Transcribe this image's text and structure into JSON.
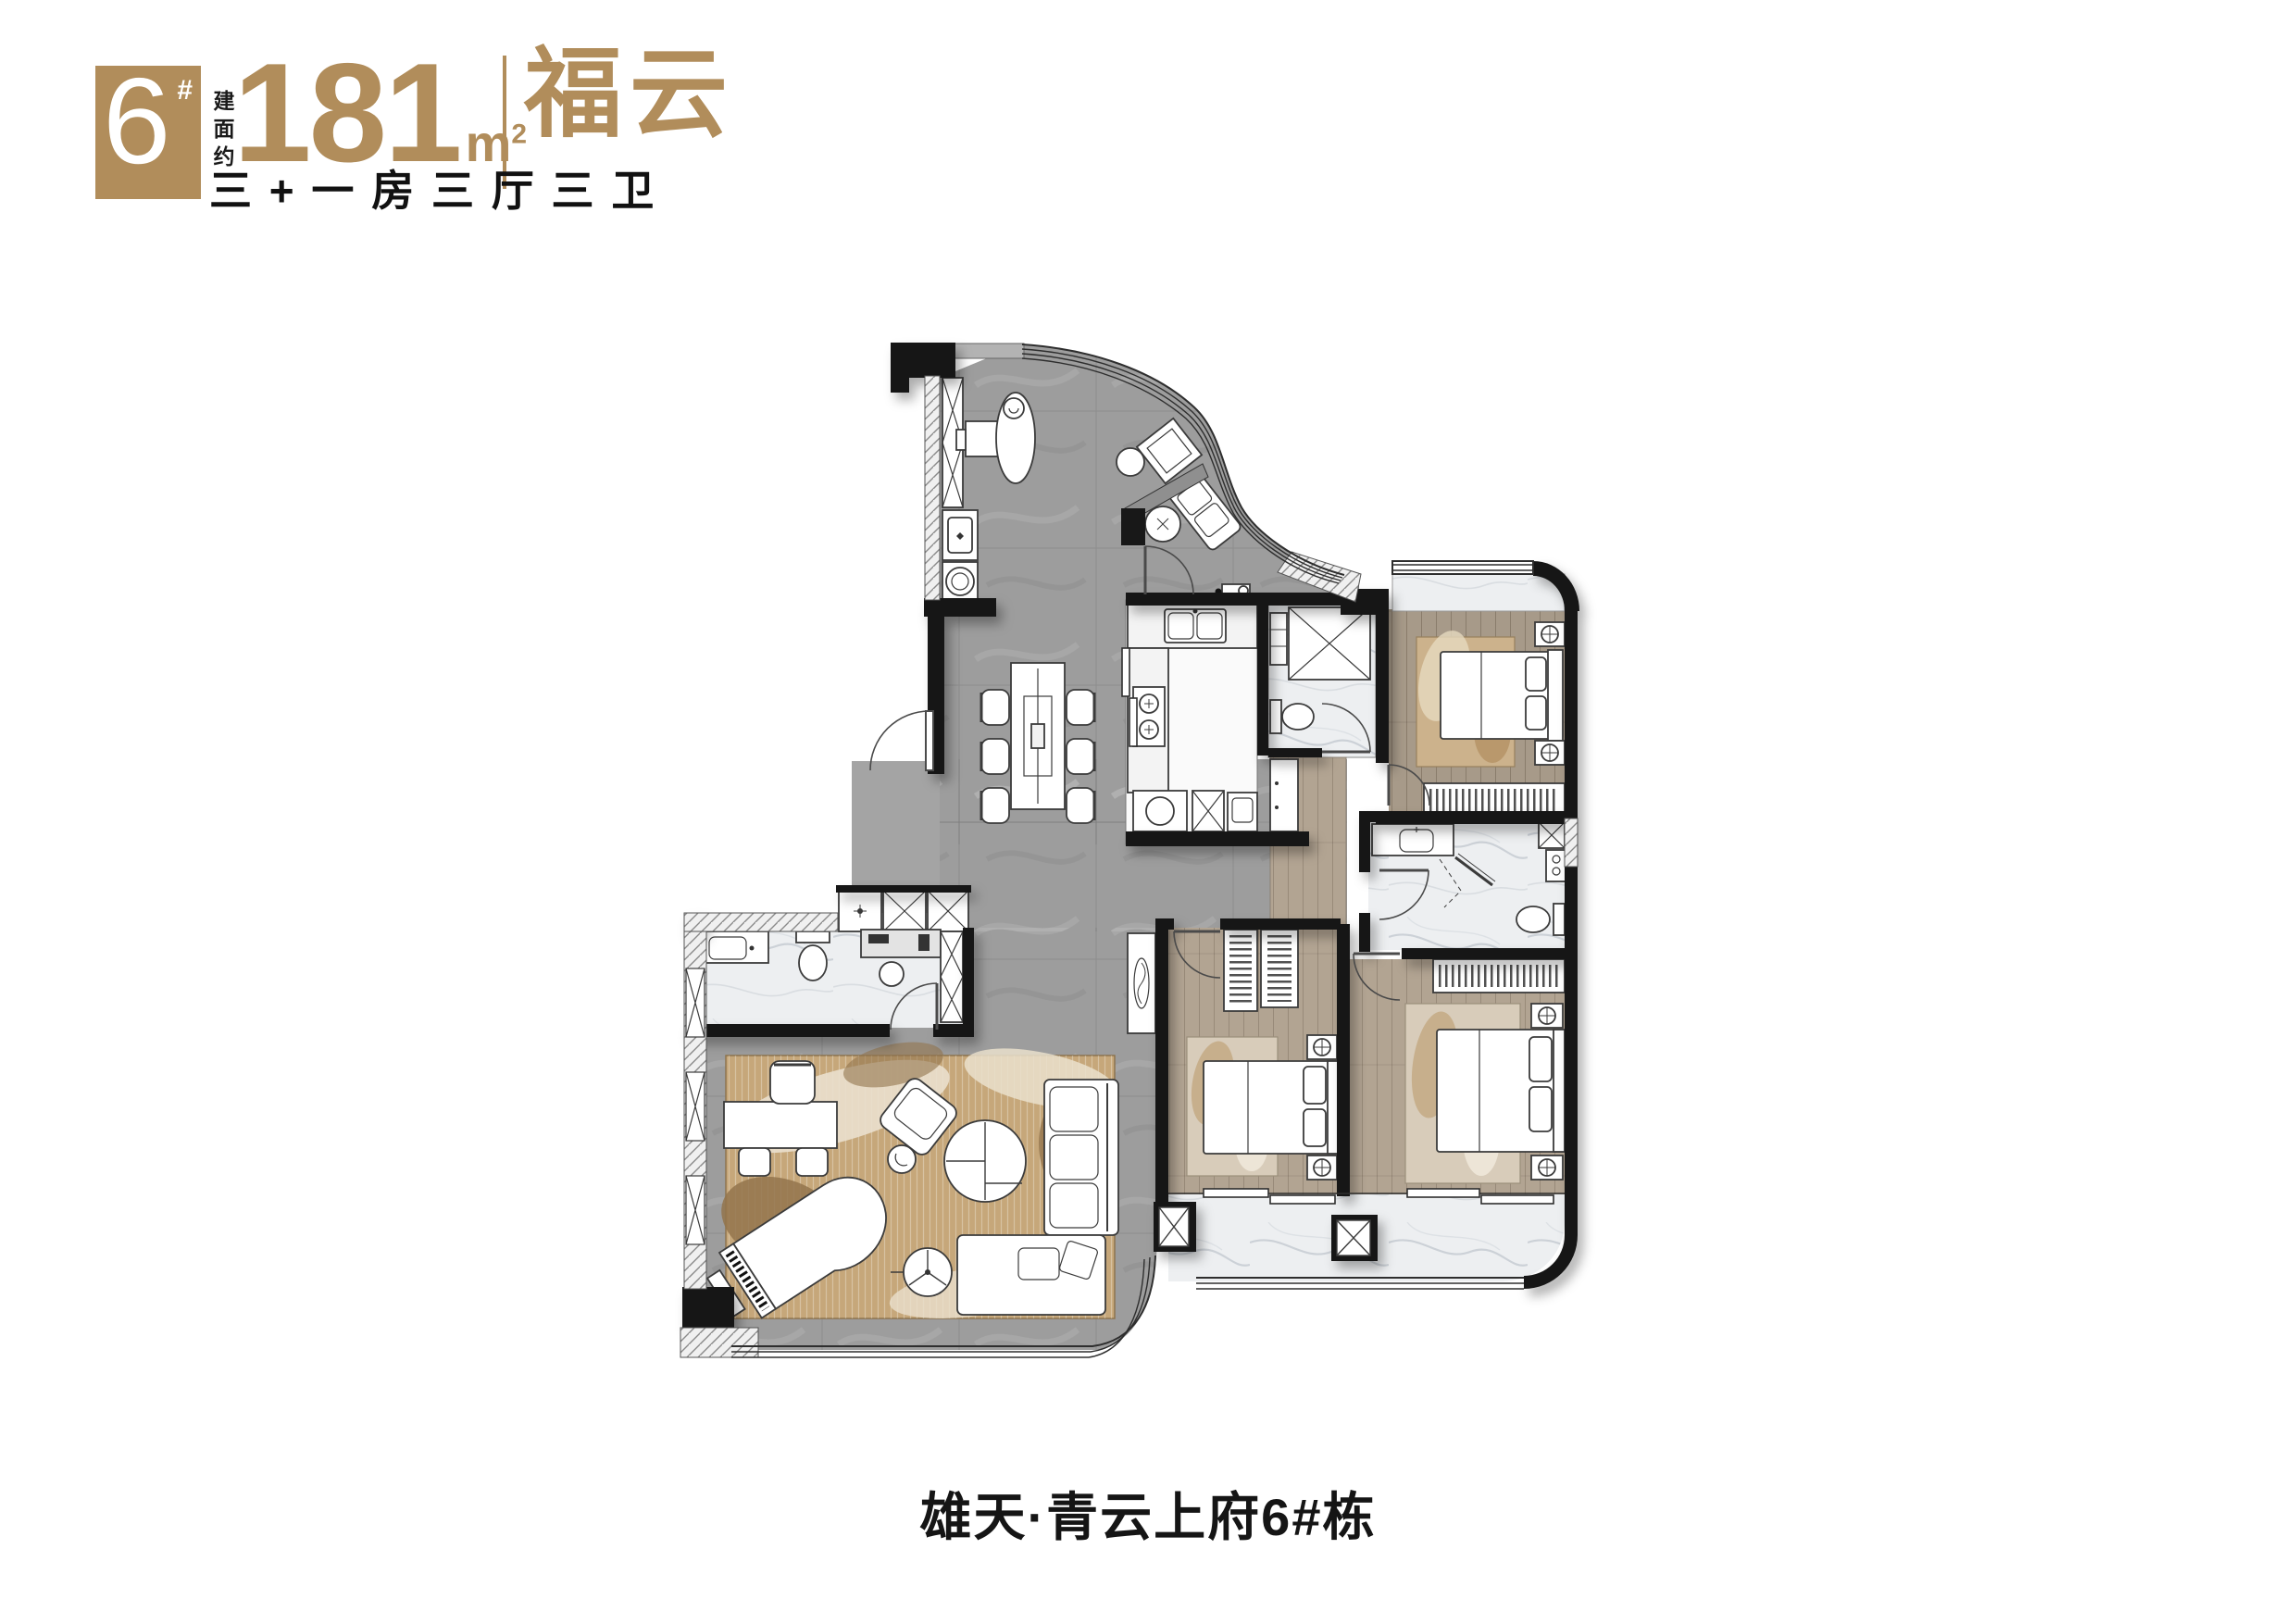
{
  "header": {
    "block_number": "6",
    "block_suffix": "#",
    "area_label": "建面约",
    "area_value": "181",
    "area_unit": "m",
    "area_unit_exp": "2",
    "brand": "福云",
    "layout_tagline": "三 + 一 房 三 厅 三 卫"
  },
  "footer": {
    "project_title": "雄天·青云上府6#栋"
  },
  "colors": {
    "gold": "#b18d5b",
    "wall_black": "#181818",
    "floor_gray": "#9d9d9d",
    "floor_wood": "#a99c8b",
    "floor_wood_light": "#b3a695",
    "floor_marble": "#edeff1",
    "rug_tan": "#c6a77a"
  }
}
